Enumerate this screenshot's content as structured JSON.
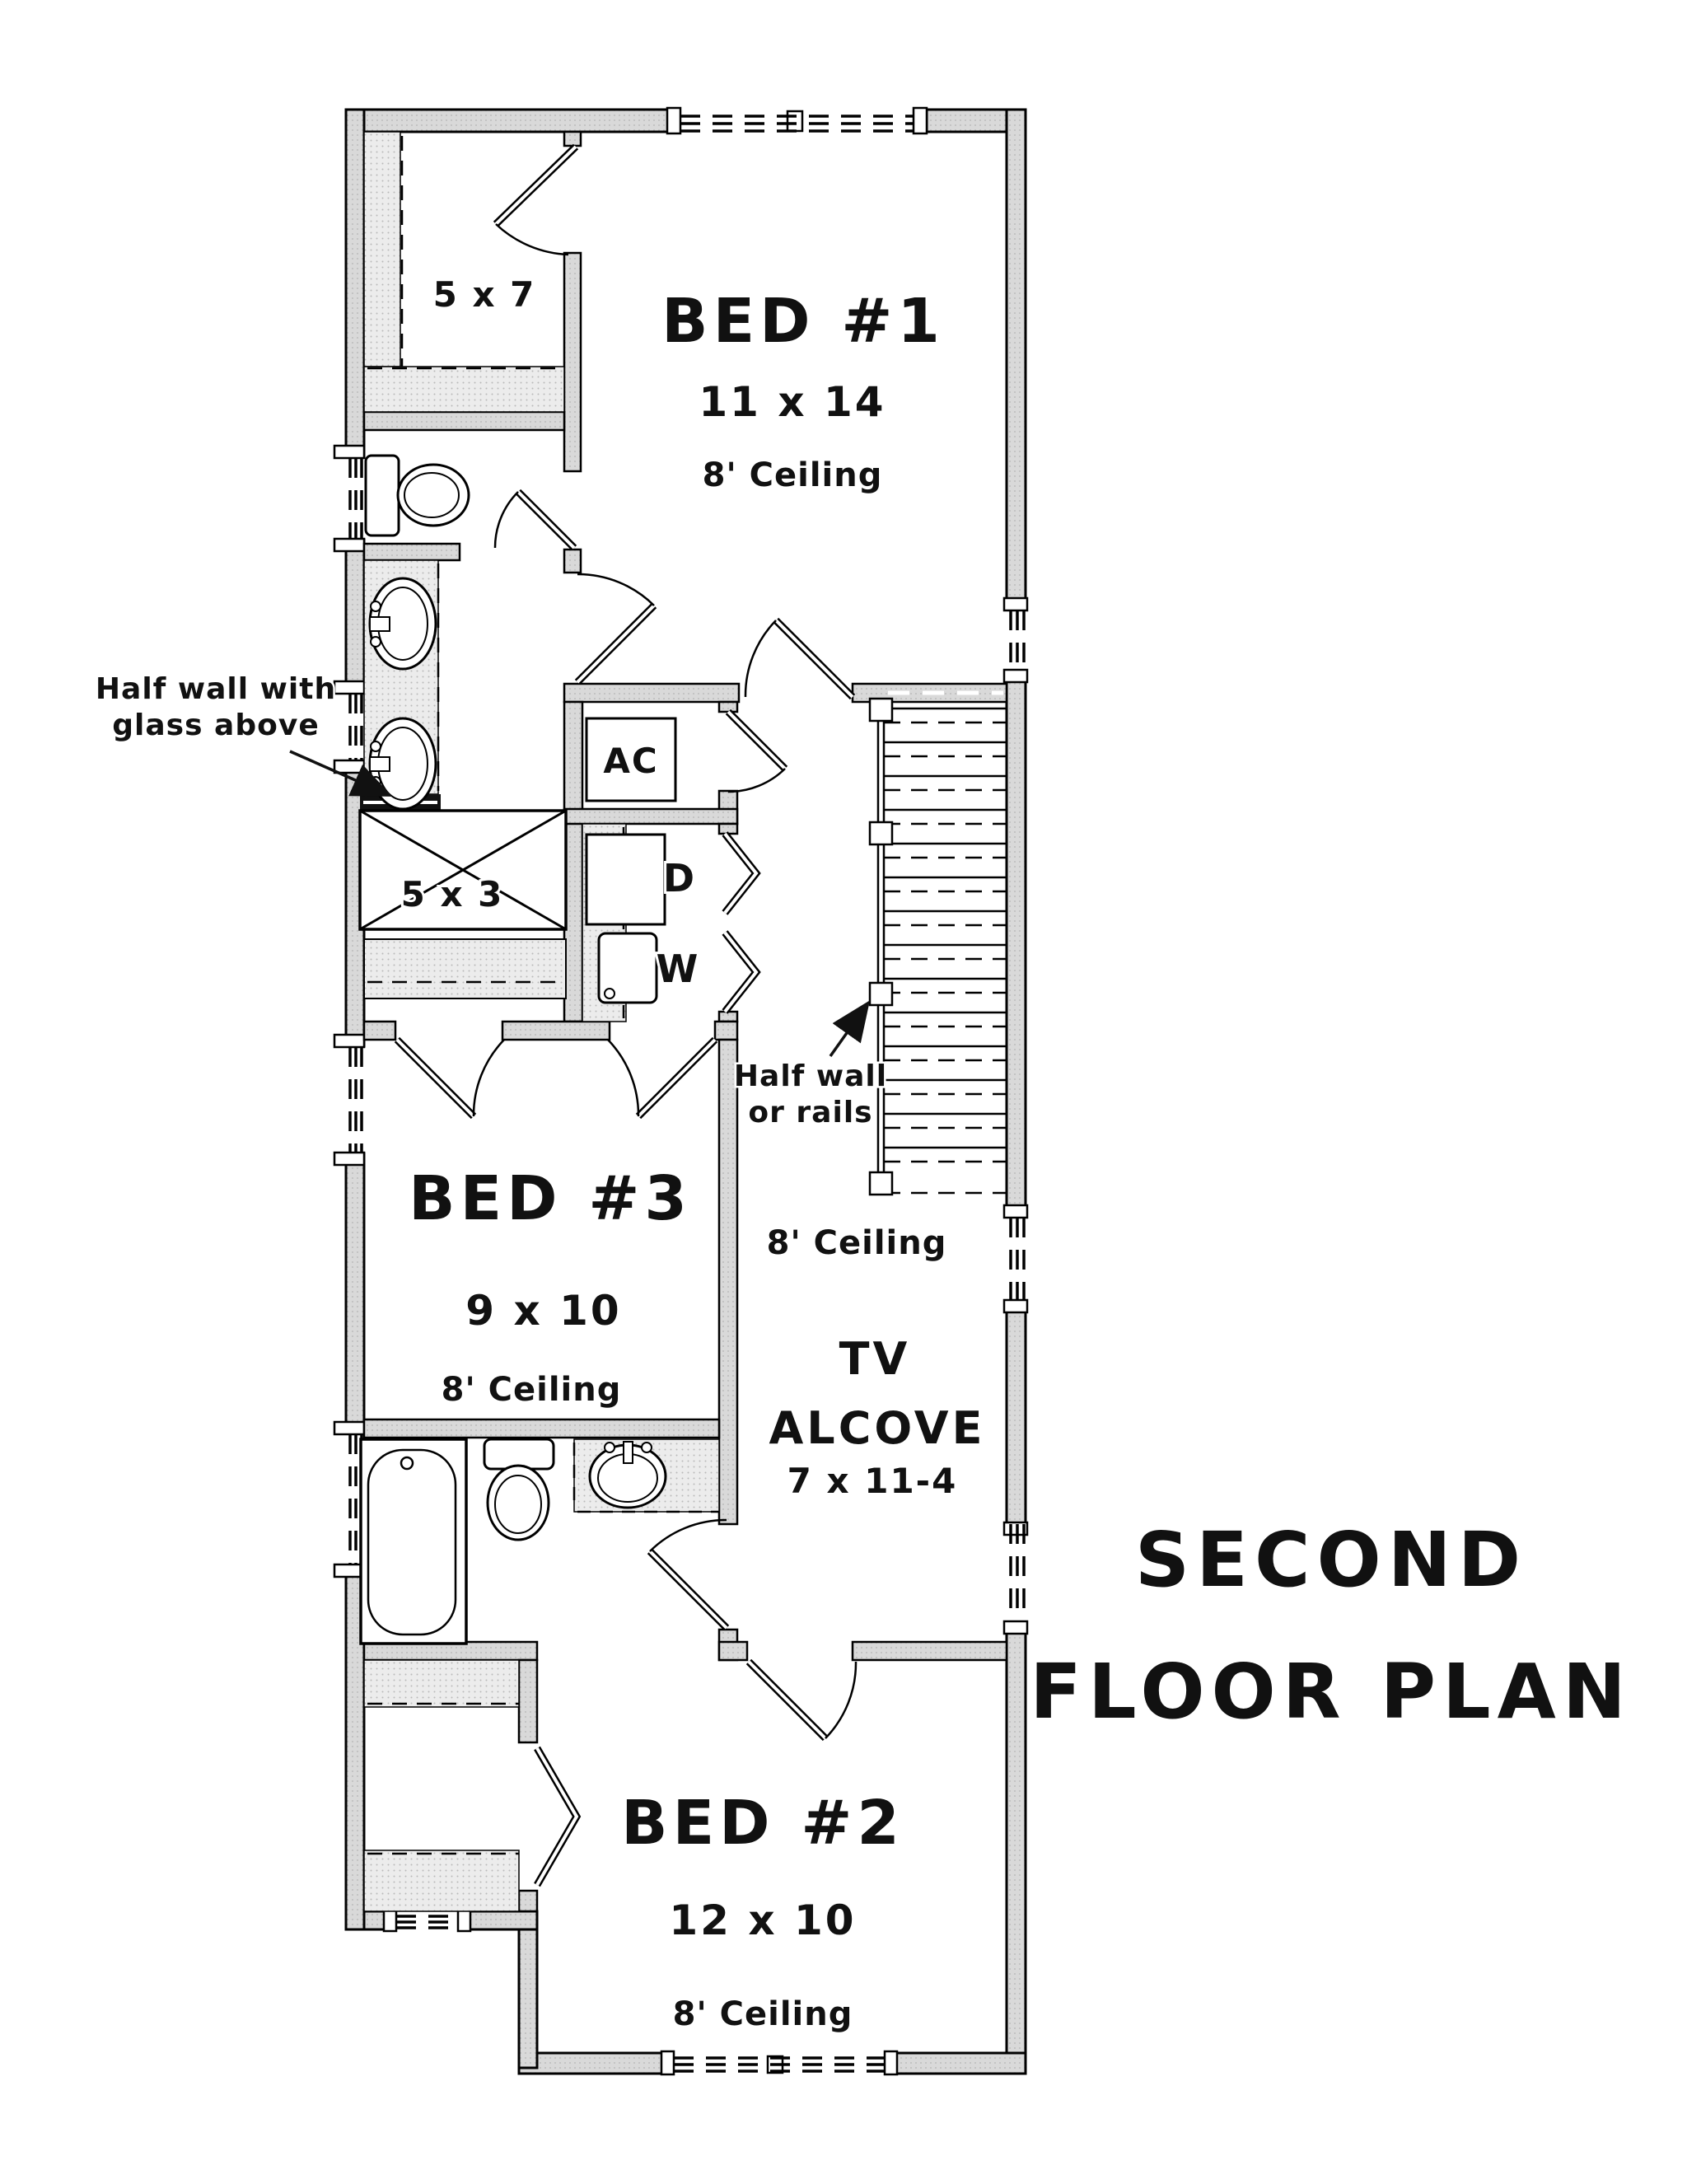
{
  "title": {
    "line1": "SECOND",
    "line2": "FLOOR PLAN"
  },
  "rooms": {
    "bed1": {
      "name": "BED #1",
      "size": "11 x 14",
      "ceiling": "8' Ceiling"
    },
    "bed2": {
      "name": "BED #2",
      "size": "12 x 10",
      "ceiling": "8' Ceiling"
    },
    "bed3": {
      "name": "BED #3",
      "size": "9 x 10",
      "ceiling": "8' Ceiling"
    },
    "walk_in_closet": {
      "size": "5 x 7"
    },
    "shower": {
      "size": "5 x 3"
    },
    "hall": {
      "ceiling": "8' Ceiling"
    },
    "tv_alcove": {
      "line1": "TV",
      "line2": "ALCOVE",
      "size": "7 x 11-4"
    }
  },
  "fixtures": {
    "ac": {
      "label": "AC"
    },
    "dryer": {
      "label": "D"
    },
    "washer": {
      "label": "W"
    }
  },
  "annotations": {
    "half_wall_glass": {
      "line1": "Half wall with",
      "line2": "glass above"
    },
    "half_wall_rails": {
      "line1": "Half wall",
      "line2": "or rails"
    }
  },
  "colors": {
    "line": "#000000",
    "wall_fill": "#d9d9d9",
    "shelf_fill": "#e6e6e6"
  }
}
